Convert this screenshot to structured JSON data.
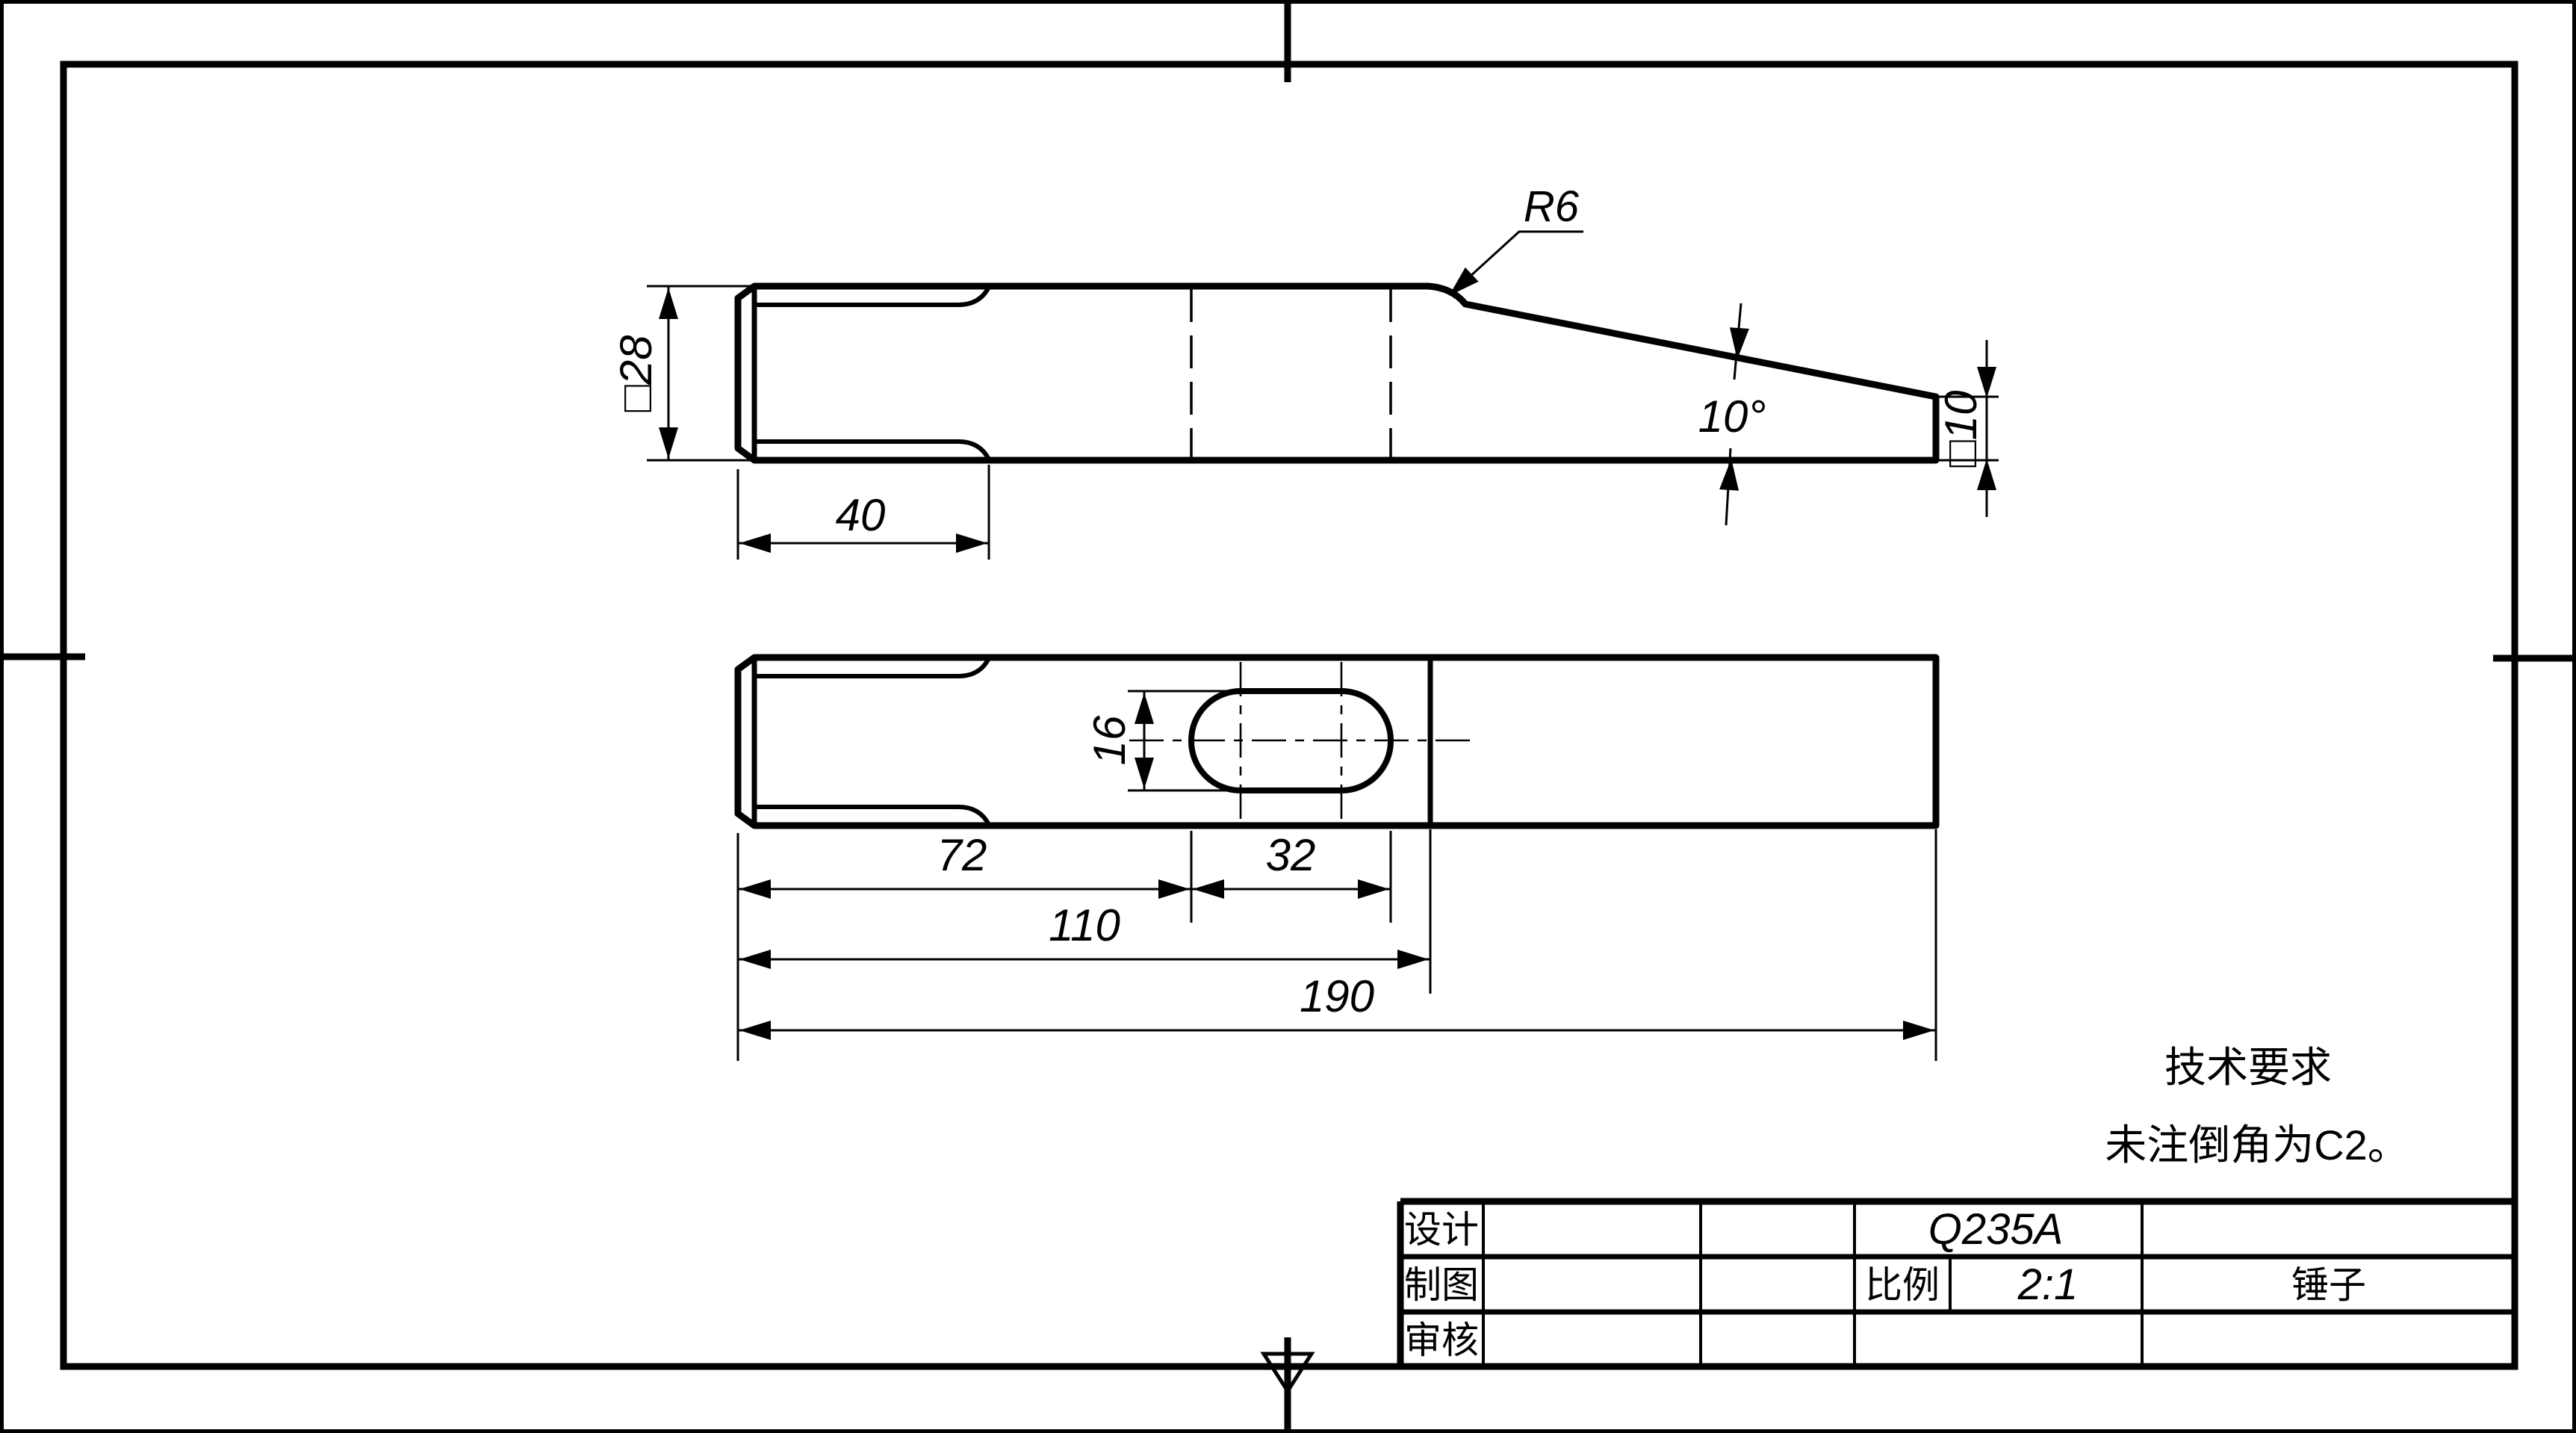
{
  "drawing": {
    "type": "engineering-drawing",
    "part_name": "锤子",
    "material": "Q235A",
    "scale": "2:1",
    "front_view": {
      "dim_face_square": "□28",
      "dim_chamfer_length": "40",
      "dim_fillet_radius": "R6",
      "dim_taper_angle": "10°",
      "dim_tip_square": "□10"
    },
    "top_view": {
      "dim_slot_width": "16",
      "dim_slot_length": "32",
      "dim_slot_position": "72",
      "dim_head_length": "110",
      "dim_total_length": "190"
    },
    "tech_requirements": {
      "title": "技术要求",
      "line1": "未注倒角为C2。"
    },
    "title_block": {
      "design_label": "设计",
      "draft_label": "制图",
      "check_label": "审核",
      "material": "Q235A",
      "scale_label": "比例",
      "scale_value": "2:1",
      "part_name": "锤子"
    }
  }
}
